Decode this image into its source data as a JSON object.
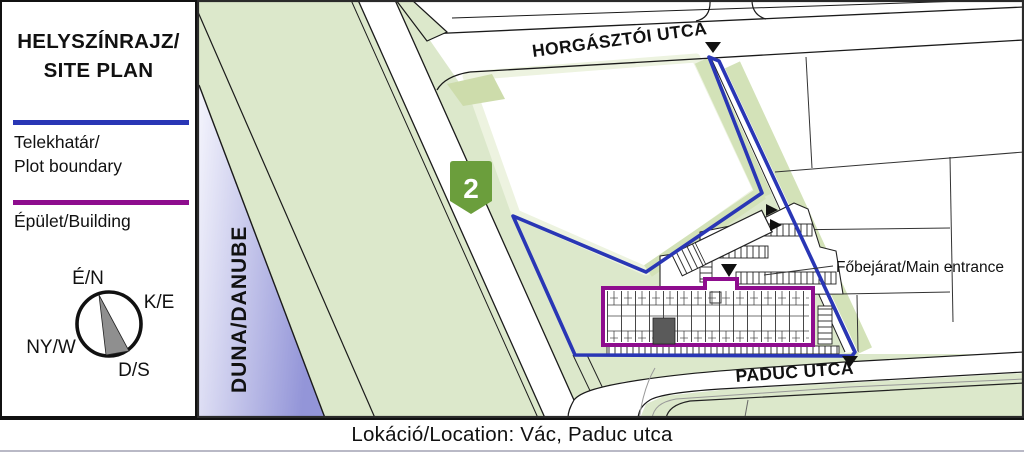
{
  "legend": {
    "title_line1": "HELYSZÍNRAJZ/",
    "title_line2": "SITE PLAN",
    "plot_boundary_label_line1": "Telekhatár/",
    "plot_boundary_label_line2": "Plot boundary",
    "building_label": "Épület/Building",
    "compass": {
      "north": "É/N",
      "east": "K/E",
      "west": "NY/W",
      "south": "D/S"
    }
  },
  "map": {
    "river_label": "DUNA/DANUBE",
    "street_top": "HORGÁSZTÓI UTCA",
    "street_bottom": "PADUC UTCA",
    "road_sign_number": "2",
    "entrance_label": "Főbejárat/Main entrance"
  },
  "colors": {
    "plot_boundary": "#2936b5",
    "building_outline": "#8e0d8e",
    "road_sign_green": "#6b9e3c",
    "map_green": "#dce8cb",
    "danube_deep": "#9395d8"
  },
  "footer": {
    "location_label": "Lokáció/Location: Vác, Paduc utca"
  }
}
